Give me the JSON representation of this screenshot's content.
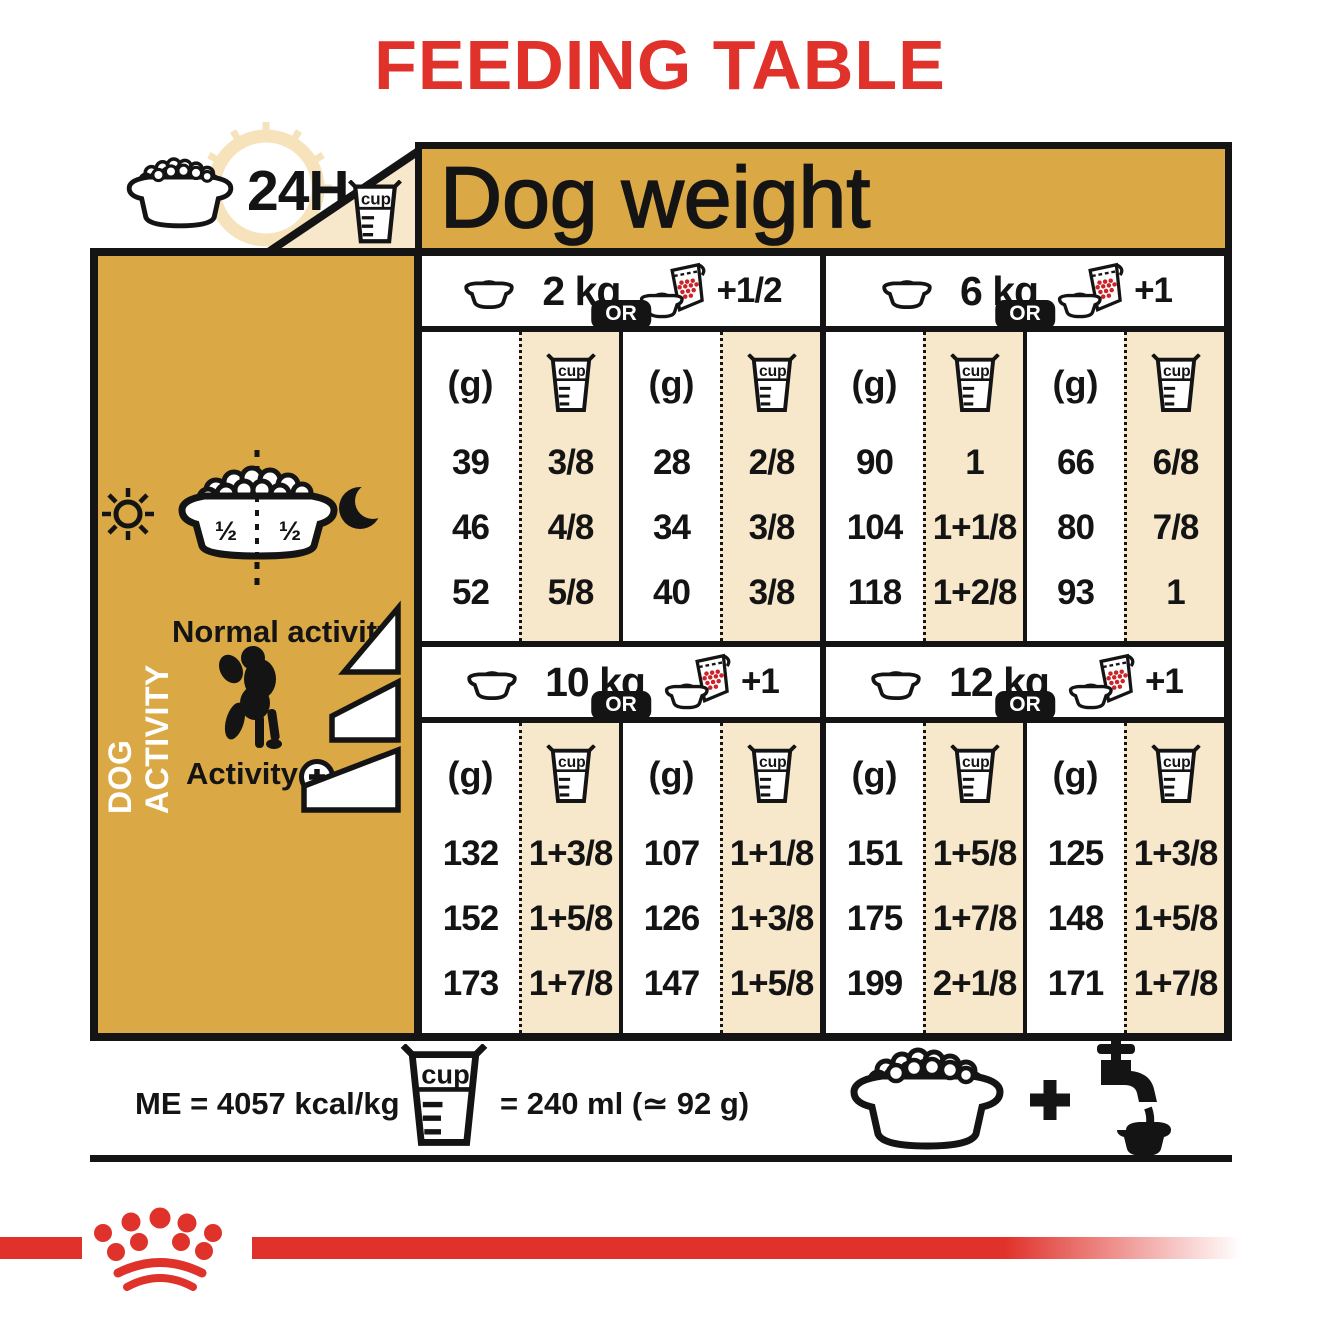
{
  "title": "FEEDING TABLE",
  "colors": {
    "gold": "#DAA844",
    "cream": "#F7E8CC",
    "red": "#E0312A",
    "ink": "#141414",
    "clock_pale": "#F6E2BB",
    "kibble_red": "#CC2329"
  },
  "header": {
    "hours_label": "24H",
    "dog_weight_label": "Dog weight"
  },
  "sidebar": {
    "vertical_label": "DOG ACTIVITY",
    "bowl_half_left": "½",
    "bowl_half_right": "½",
    "normal_activity_label": "Normal activity",
    "activity_label": "Activity"
  },
  "table": {
    "unit_g": "(g)",
    "cup_label": "cup",
    "or_label": "OR",
    "sections": [
      {
        "weight": "2 kg",
        "extra": "+1/2",
        "rows": [
          [
            "39",
            "3/8",
            "28",
            "2/8"
          ],
          [
            "46",
            "4/8",
            "34",
            "3/8"
          ],
          [
            "52",
            "5/8",
            "40",
            "3/8"
          ]
        ]
      },
      {
        "weight": "6 kg",
        "extra": "+1",
        "rows": [
          [
            "90",
            "1",
            "66",
            "6/8"
          ],
          [
            "104",
            "1+1/8",
            "80",
            "7/8"
          ],
          [
            "118",
            "1+2/8",
            "93",
            "1"
          ]
        ]
      },
      {
        "weight": "10 kg",
        "extra": "+1",
        "rows": [
          [
            "132",
            "1+3/8",
            "107",
            "1+1/8"
          ],
          [
            "152",
            "1+5/8",
            "126",
            "1+3/8"
          ],
          [
            "173",
            "1+7/8",
            "147",
            "1+5/8"
          ]
        ]
      },
      {
        "weight": "12 kg",
        "extra": "+1",
        "rows": [
          [
            "151",
            "1+5/8",
            "125",
            "1+3/8"
          ],
          [
            "175",
            "1+7/8",
            "148",
            "1+5/8"
          ],
          [
            "199",
            "2+1/8",
            "171",
            "1+7/8"
          ]
        ]
      }
    ]
  },
  "footer": {
    "me_label": "ME = 4057 kcal/kg",
    "cup_equiv": "= 240 ml (≃ 92 g)"
  },
  "icons": [
    "kibble-bowl-icon",
    "clock-24h-icon",
    "measuring-cup-icon",
    "bowl-icon",
    "bowl-pouch-icon",
    "sun-icon",
    "moon-icon",
    "poodle-icon",
    "activity-plus-icon",
    "activity-level-triangles",
    "plus-icon",
    "water-tap-icon",
    "royal-canin-crown-logo"
  ]
}
